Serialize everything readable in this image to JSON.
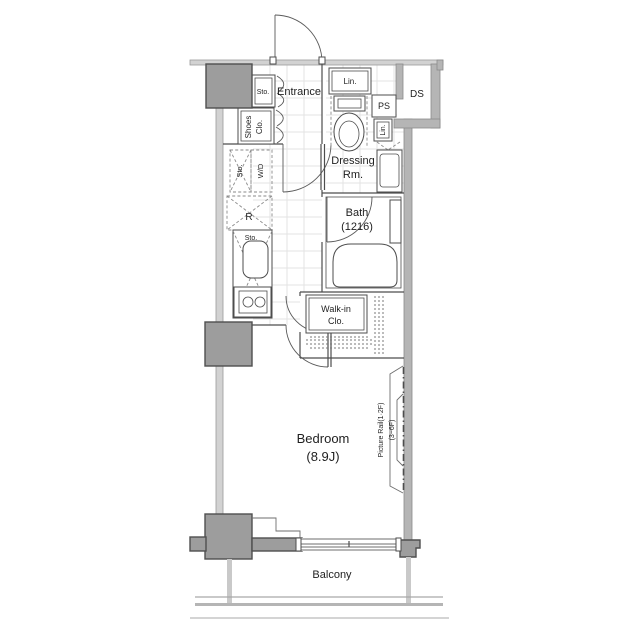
{
  "labels": {
    "entrance": "Entrance",
    "sto_entrance": "Sto.",
    "shoes_line1": "Shoes",
    "shoes_line2": "Clo.",
    "sto_wd_sto": "Sto.",
    "sto_wd_wd": "W/D",
    "lin_upper": "Lin.",
    "ps": "PS",
    "ds": "DS",
    "lin_lower": "Lin.",
    "dressing_line1": "Dressing",
    "dressing_line2": "Rm.",
    "bath_line1": "Bath",
    "bath_line2": "(1216)",
    "fridge": "R",
    "sto_kitchen": "Sto.",
    "walkin_line1": "Walk-in",
    "walkin_line2": "Clo.",
    "bedroom_line1": "Bedroom",
    "bedroom_line2": "(8.9J)",
    "picture_rail_1": "Picture Rail(1·2F)",
    "picture_rail_2": "(3~6F)",
    "balcony": "Balcony"
  },
  "colors": {
    "background": "#ffffff",
    "wall_thin": "#d2d2d2",
    "wall_medium": "#b5b5b5",
    "column": "#9d9d9d",
    "outline": "#4d4d4d",
    "grid": "#e3e3e3",
    "text": "#1f1f1f"
  }
}
